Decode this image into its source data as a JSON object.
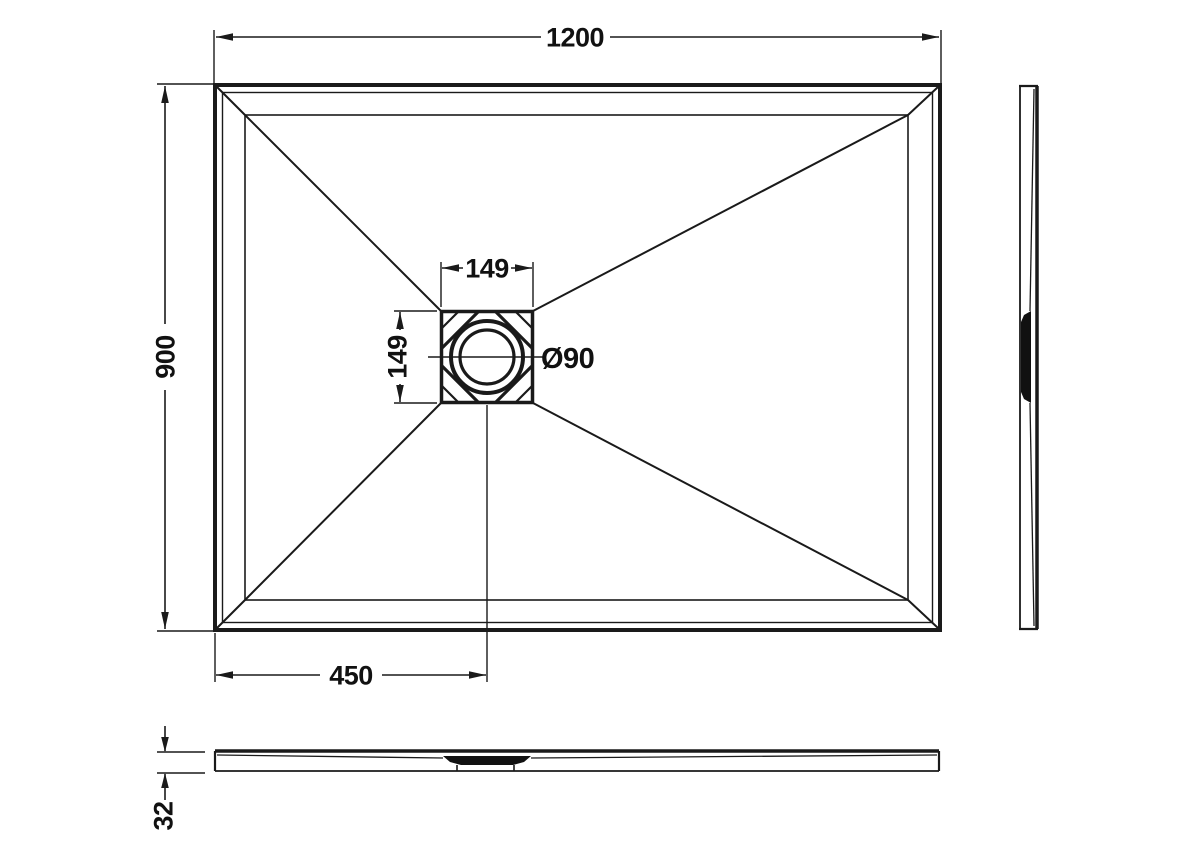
{
  "drawing": {
    "kind": "shower-tray-technical-drawing",
    "background_color": "#ffffff",
    "line_color": "#1a1a1a"
  },
  "dimensions": {
    "overall_width": "1200",
    "overall_depth": "900",
    "drain_center_from_left": "450",
    "drain_cutout_width": "149",
    "drain_cutout_height": "149",
    "waste_outlet_diameter": "Ø90",
    "tray_thickness": "32"
  }
}
